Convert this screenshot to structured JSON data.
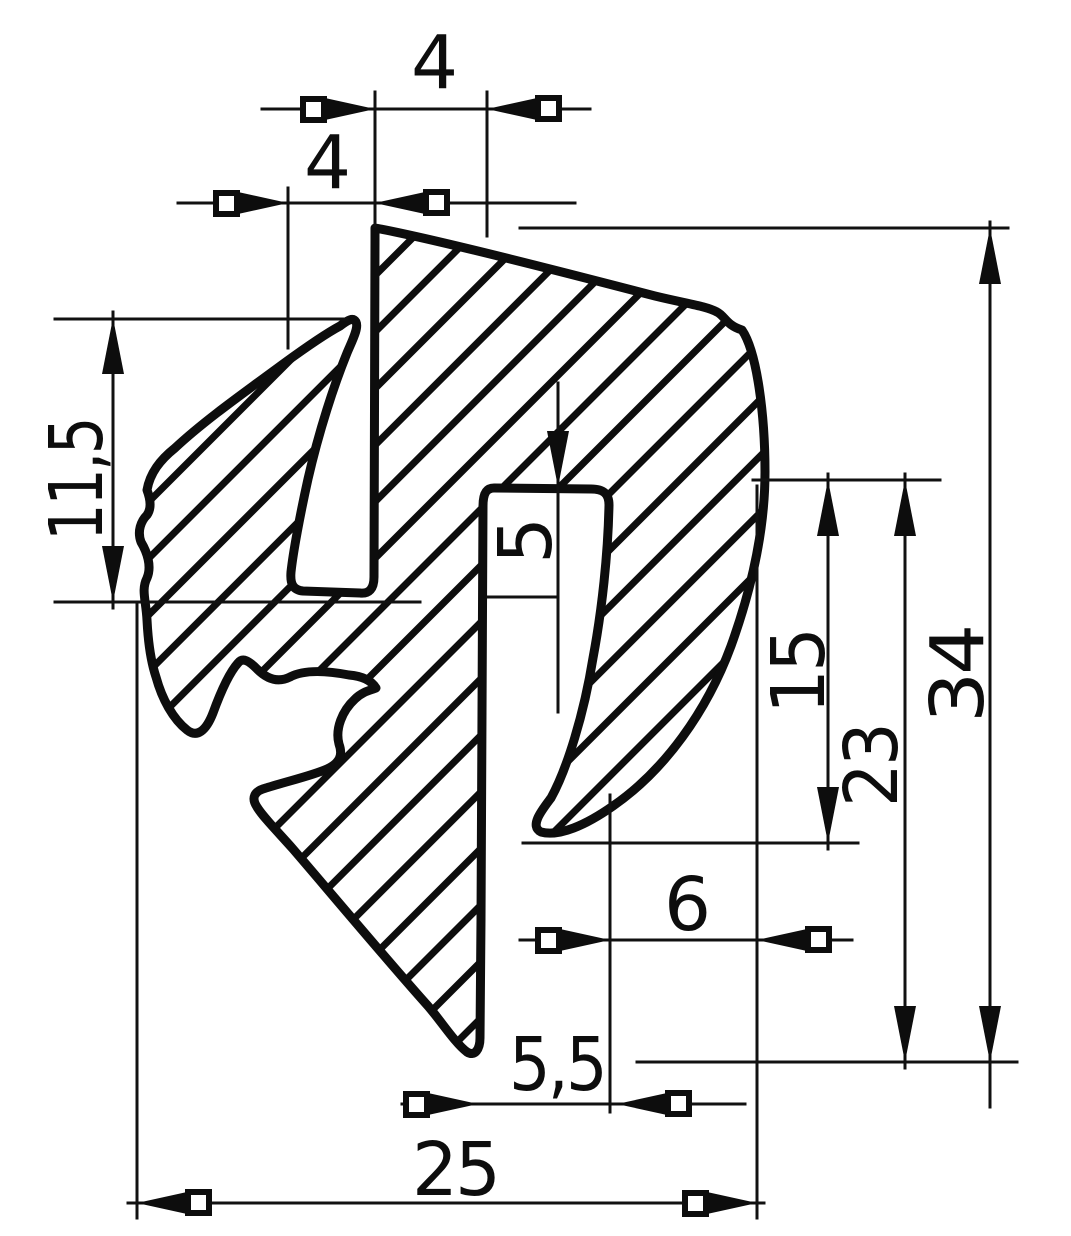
{
  "drawing": {
    "kind": "technical cross-section drawing (hatched extrusion seal profile)",
    "style": "black ink scan on white",
    "ink_color": "#0d0d0d",
    "background_color": "#ffffff",
    "hatch": "45-degree diagonal section hatching"
  },
  "dims": {
    "top_wall_width": "4",
    "lip_offset": "4",
    "lip_height": "11,5",
    "slot_depth": "5",
    "tongue_height": "15",
    "channel_height": "23",
    "overall_height": "34",
    "tongue_clearance": "6",
    "slot_width": "5,5",
    "overall_width": "25"
  }
}
